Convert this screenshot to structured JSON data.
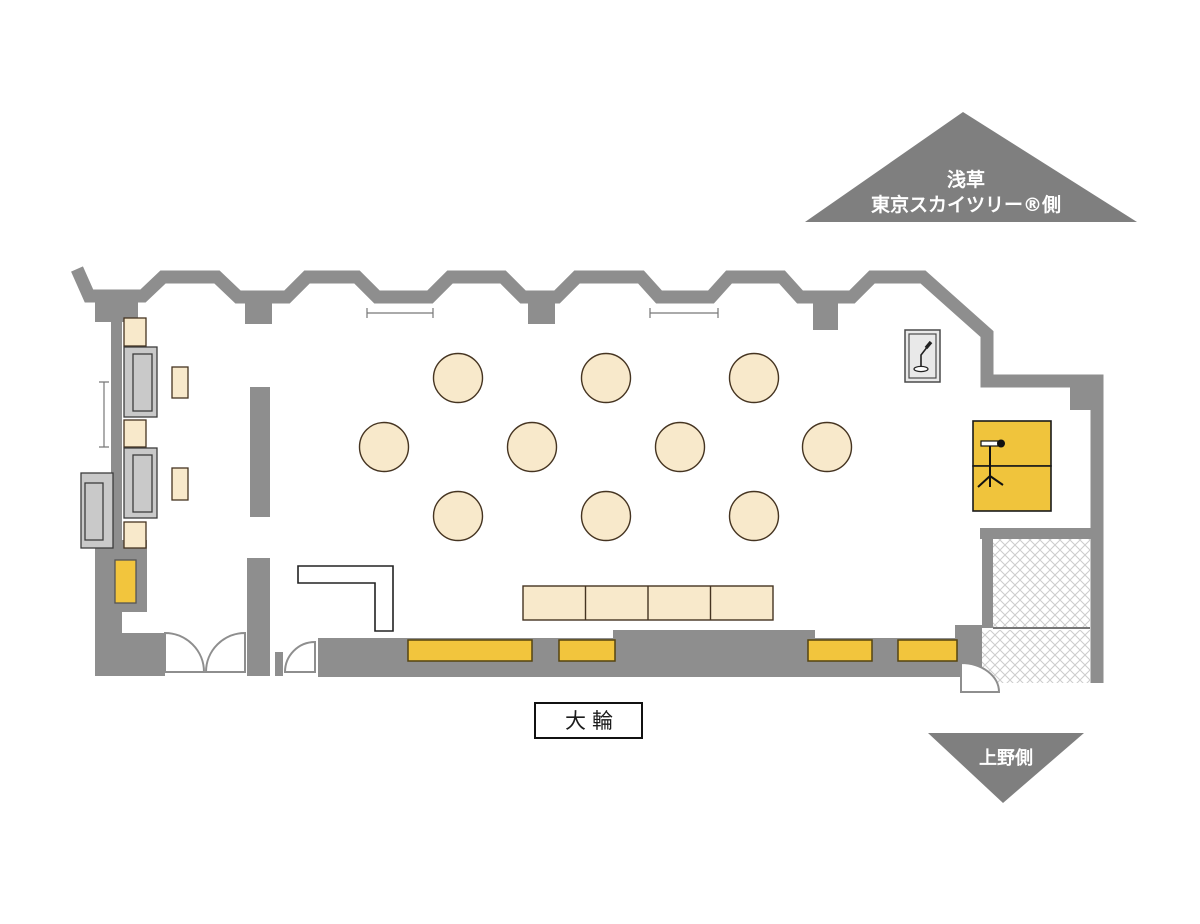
{
  "markers": {
    "top": {
      "line1": "浅草",
      "line2": "東京スカイツリー®側"
    },
    "bottom": {
      "label": "上野側"
    }
  },
  "room": {
    "name": "大輪"
  },
  "furniture": {
    "round_tables": 10,
    "long_table_segments": 4,
    "wall_benches": 4,
    "side_tables": 5,
    "equipment_boxes": 3,
    "microphone_stands": 2
  },
  "colors": {
    "wall_gray": "#8e8e8e",
    "triangle_gray": "#7f7f7f",
    "table_cream": "#f8e9cb",
    "table_stroke": "#453421",
    "accent_yellow": "#f2c53d",
    "equipment_gray": "#c9c9c9",
    "hatch_line": "#cccccc"
  }
}
